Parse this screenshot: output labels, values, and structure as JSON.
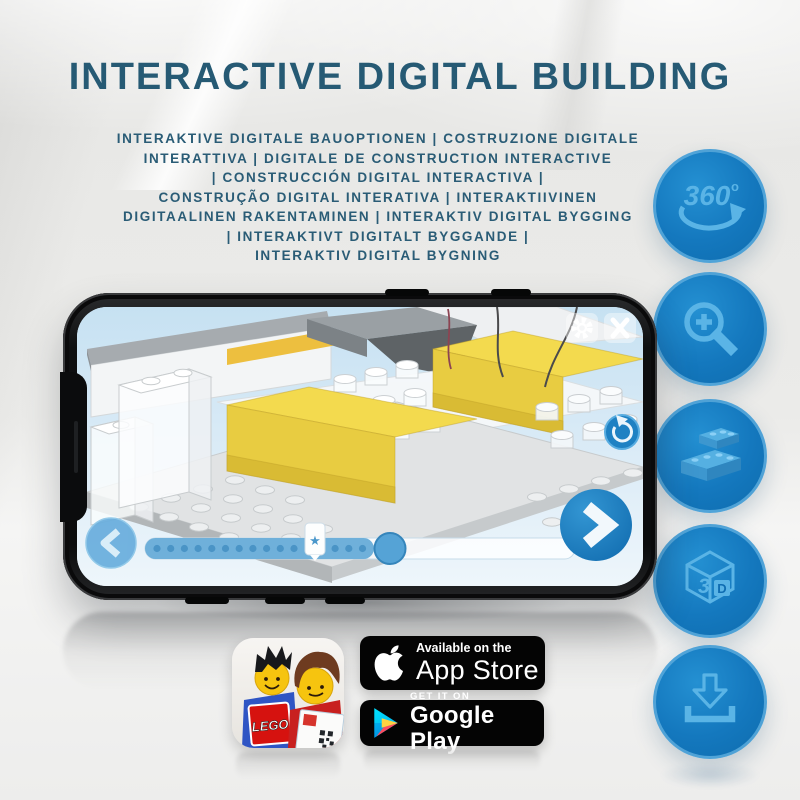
{
  "header": {
    "title": "INTERACTIVE DIGITAL BUILDING",
    "subtitle_lines": [
      "INTERAKTIVE DIGITALE BAUOPTIONEN | COSTRUZIONE DIGITALE",
      "INTERATTIVA | DIGITALE DE CONSTRUCTION INTERACTIVE",
      "| CONSTRUCCIÓN DIGITAL INTERACTIVA |",
      "CONSTRUÇÃO DIGITAL INTERATIVA | INTERAKTIIVINEN",
      "DIGITAALINEN RAKENTAMINEN | INTERAKTIV DIGITAL BYGGING",
      "| INTERAKTIVT DIGITALT BYGGANDE |",
      "INTERAKTIV DIGITAL BYGNING"
    ]
  },
  "feature_rail": {
    "items": [
      {
        "id": "rotate-360",
        "label": "360",
        "degree": "o"
      },
      {
        "id": "zoom-in"
      },
      {
        "id": "bricks"
      },
      {
        "id": "three-d",
        "digit": "3",
        "letter": "D"
      },
      {
        "id": "download"
      }
    ]
  },
  "badges": {
    "app_store": {
      "top": "Available on the",
      "bottom": "App Store"
    },
    "google_play": {
      "top": "GET IT ON",
      "bottom": "Google Play"
    }
  },
  "app_icon": {
    "logo_text": "LEGO"
  },
  "colors": {
    "title_blue": "#265a74",
    "circle_blue": "#1478be",
    "icon_light_blue": "#5ab4e6",
    "slab_yellow": "#f3da4e",
    "badge_black": "#040404"
  }
}
